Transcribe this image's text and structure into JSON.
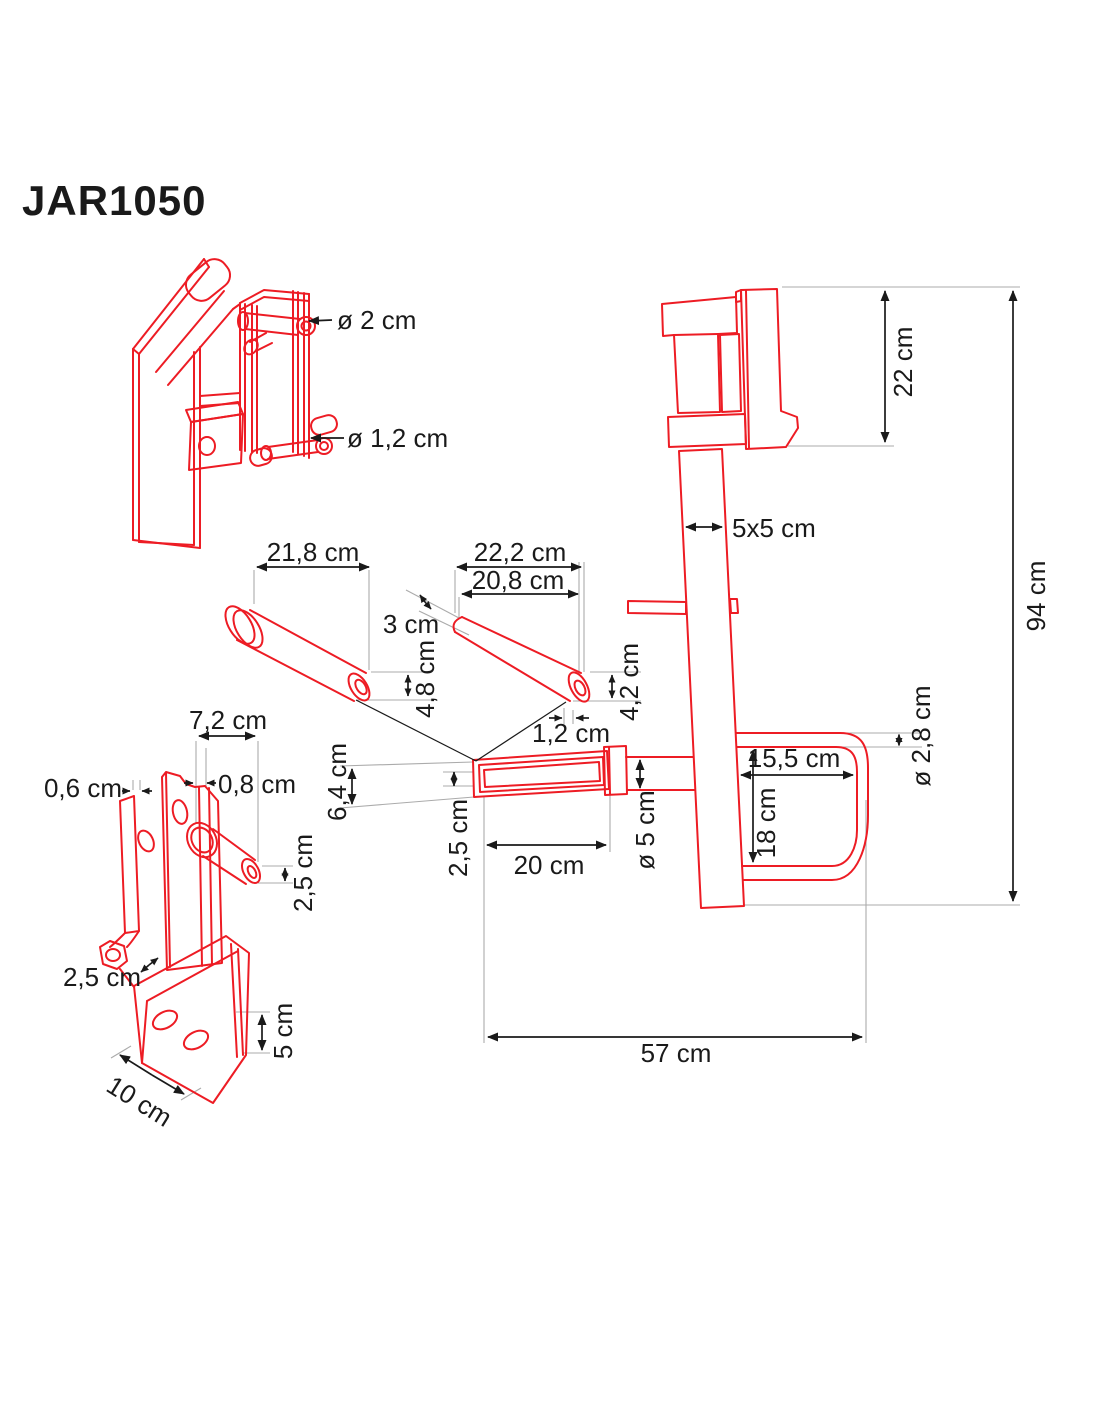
{
  "title": "JAR1050",
  "colors": {
    "part_outline": "#ED1C24",
    "dimension_lines": "#1A1A1A",
    "extension_lines": "#ABABAB",
    "background": "#FFFFFF"
  },
  "figures": {
    "upright_bracket": {
      "pin_large_diameter": "ø 2 cm",
      "pin_small_diameter": "ø 1,2 cm"
    },
    "pin_left": {
      "length": "21,8 cm",
      "end_diameter": "4,8 cm"
    },
    "pin_right": {
      "total_length": "22,2 cm",
      "body_length": "20,8 cm",
      "tip_length": "3 cm",
      "end_diameter": "4,2 cm",
      "hole_diameter": "1,2 cm"
    },
    "side_bracket": {
      "top_width": "7,2 cm",
      "back_plate_thickness": "0,6 cm",
      "front_plate_thickness": "0,8 cm",
      "pin_diameter": "2,5 cm",
      "hole_offset": "2,5 cm",
      "base_length": "10 cm",
      "base_height": "5 cm"
    },
    "sleeve": {
      "outer_height": "6,4 cm",
      "wall_offset": "2,5 cm",
      "length": "20 cm",
      "bar_diameter": "ø 5 cm"
    },
    "main_unit": {
      "head_height": "22 cm",
      "total_height": "94 cm",
      "tube_section": "5x5 cm",
      "hook_bar_diameter": "ø 2,8 cm",
      "hook_depth": "15,5 cm",
      "hook_opening_height": "18 cm",
      "total_depth": "57 cm"
    }
  }
}
